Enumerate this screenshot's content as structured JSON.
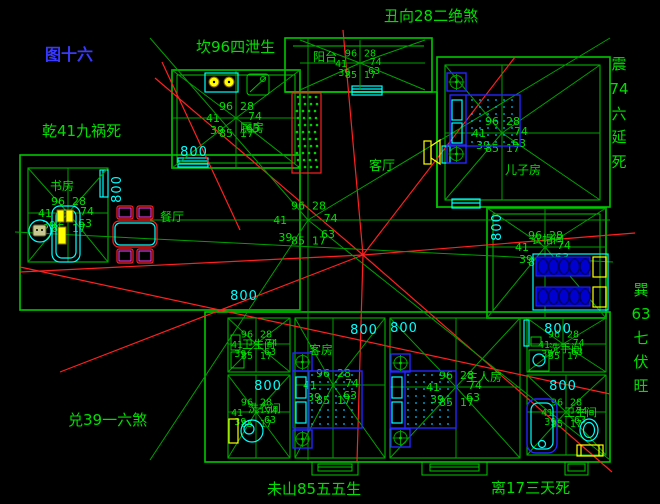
{
  "figure_label": "图十六",
  "perimeter": {
    "top_left": "坎96四泄生",
    "top_center": "丑向28二绝煞",
    "left_upper": "乾41九祸死",
    "left_lower": "兑39一六煞",
    "bottom_left": "未山85五五生",
    "bottom_right": "离17三天死",
    "right_upper_chars": [
      "震",
      "74",
      "六",
      "延",
      "死"
    ],
    "right_lower_chars": [
      "巽",
      "63",
      "七",
      "伏",
      "旺"
    ]
  },
  "star_numbers": {
    "top_left": "96",
    "top_right": "28",
    "left": "41",
    "right": "74",
    "bottom_left": "39",
    "bottom_right": "63",
    "bottom_center_left": "85",
    "bottom_center_right": "17"
  },
  "rooms": {
    "kitchen": {
      "label": "厨房"
    },
    "study": {
      "label": "书房"
    },
    "balcony": {
      "label": "阳台"
    },
    "living": {
      "label": "客厅"
    },
    "dining": {
      "label": "餐厅"
    },
    "son": {
      "label": "儿子房"
    },
    "closet": {
      "label": "衣帽间"
    },
    "wc_upper_left": {
      "label": "卫生间"
    },
    "laundry": {
      "label": "洗衣间"
    },
    "guest": {
      "label": "客房"
    },
    "master": {
      "label": "主人房"
    },
    "wash_upper_right": {
      "label": "洗手间"
    },
    "bath_lower_right": {
      "label": "卫生间"
    }
  },
  "dimensions": {
    "value": "800"
  },
  "colors": {
    "wall_green": "#00c800",
    "annotation_green": "#00e000",
    "divination_red": "#dd0000",
    "dimension_cyan": "#00ffff",
    "furniture_blue": "#2525ff",
    "fixture_yellow": "#ffff00",
    "figure_blue": "#3a3aff"
  }
}
